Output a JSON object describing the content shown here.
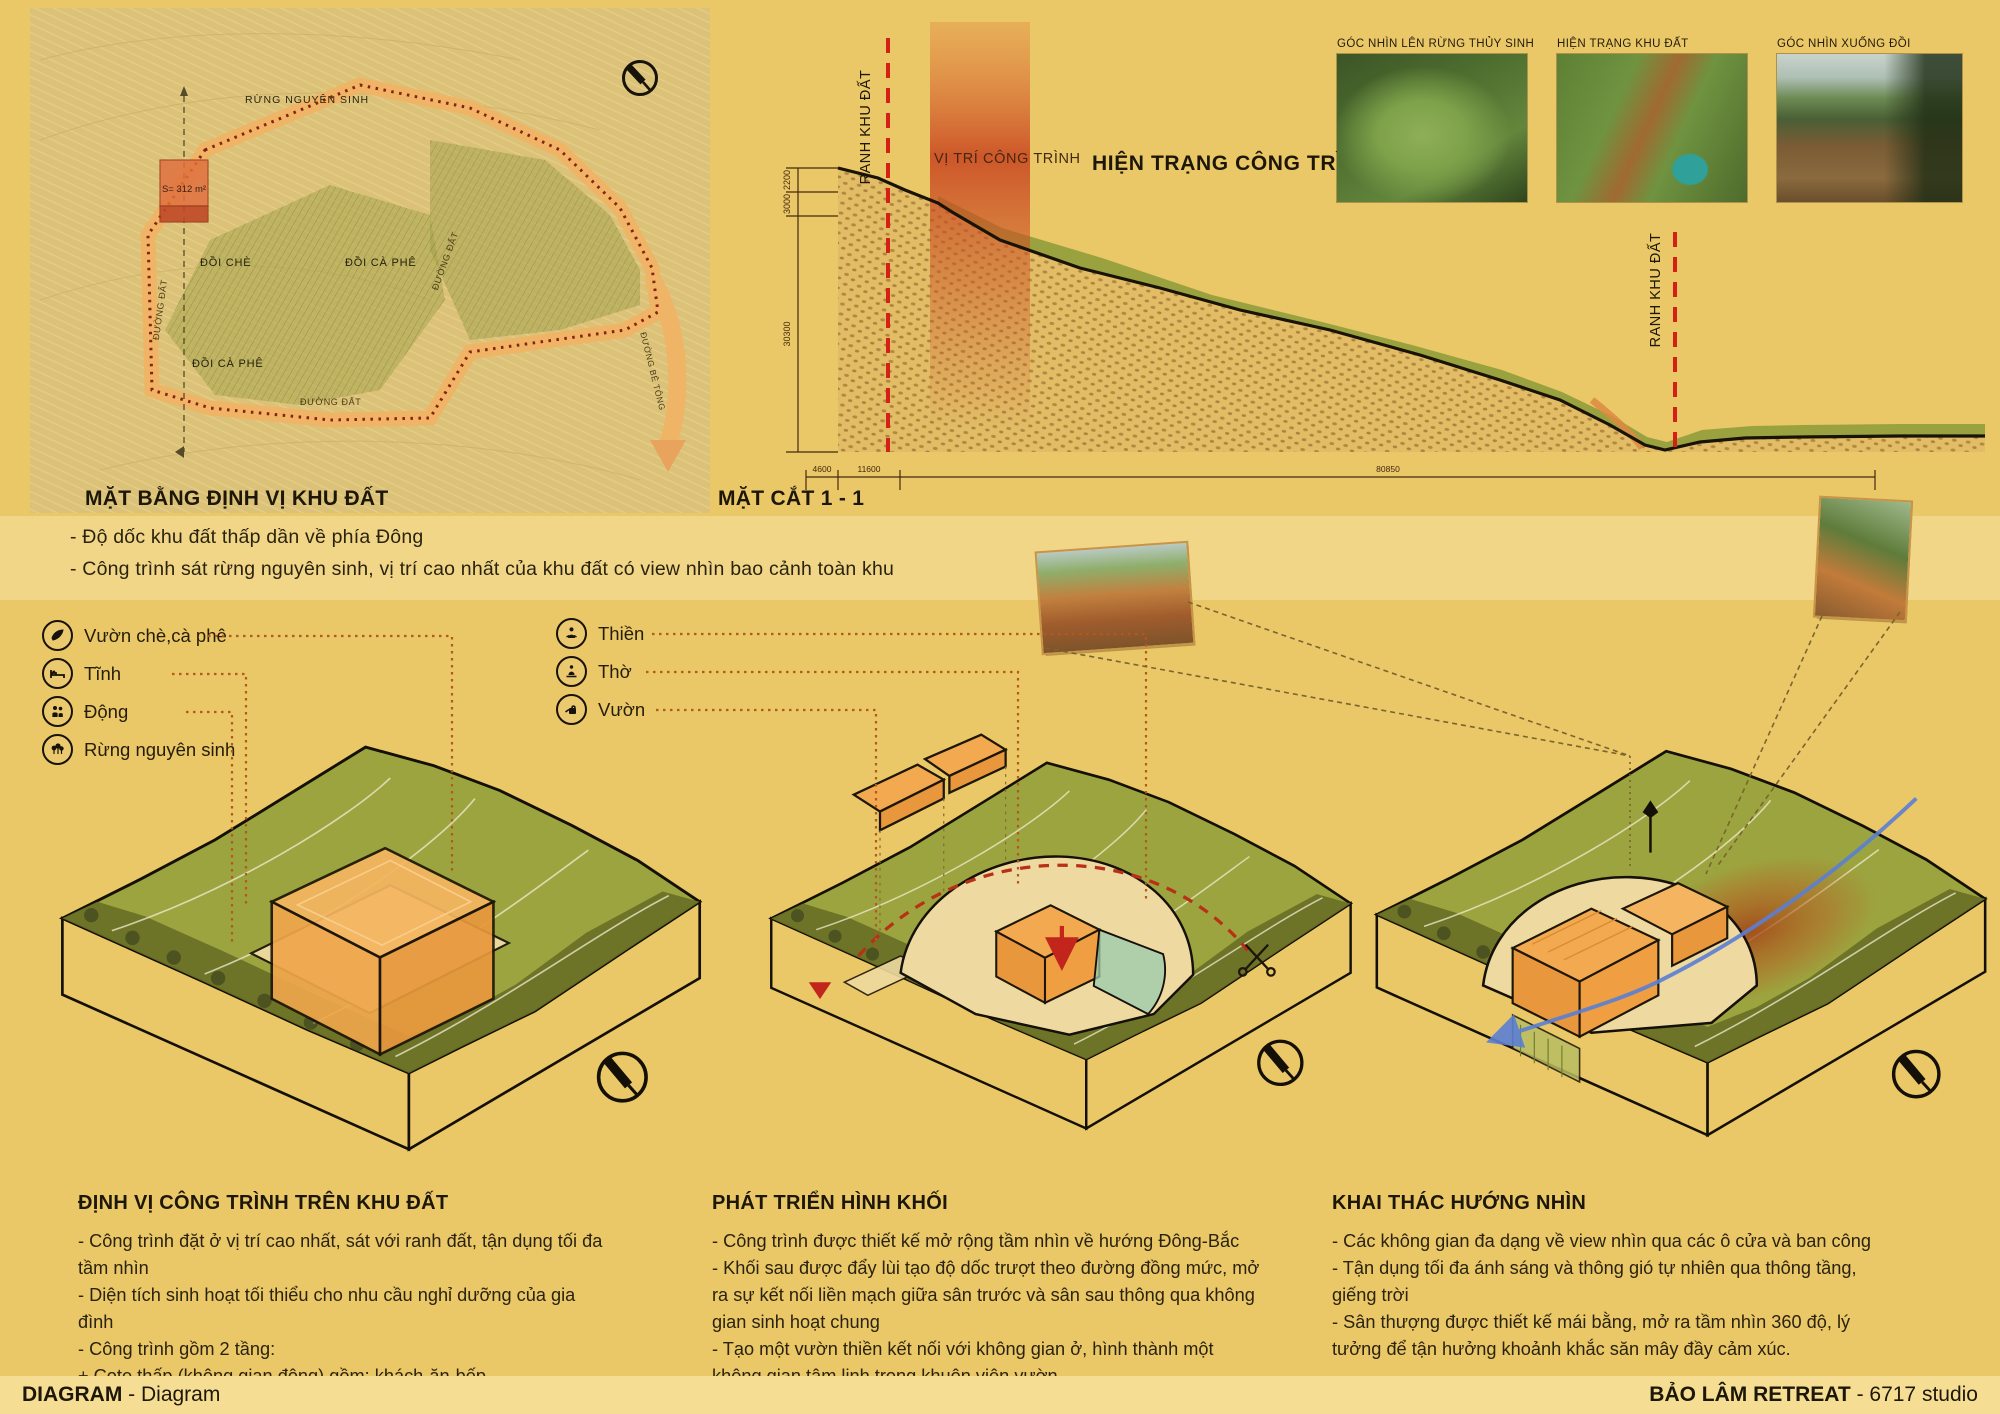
{
  "colors": {
    "board_bg": "#eac767",
    "panel_light": "#f1d687",
    "terrain_green": "#9ca43f",
    "dark_olive_band": "#6b7226",
    "building_orange": "#f0a84e",
    "platform_cream": "#eedaa0",
    "accent_red": "#d42015",
    "leader_orange": "#b3591d",
    "road_orange": "#efb466",
    "boundary_red": "#8b2012",
    "ink": "#1d1708",
    "wind_blue": "#5b7fd4"
  },
  "plan": {
    "title": "MẶT BẰNG ĐỊNH VỊ KHU ĐẤT",
    "area_label": "S= 312 m²",
    "labels": {
      "forest": "RỪNG NGUYÊN SINH",
      "tea_hill": "ĐỒI CHÈ",
      "coffee_hill": "ĐỒI CÀ PHÊ",
      "coffee_hill_2": "ĐỒI CÀ PHÊ",
      "dirt_road_left": "ĐƯỜNG ĐẤT",
      "dirt_road_bottom": "ĐƯỜNG ĐẤT",
      "dirt_road_right": "ĐƯỜNG ĐẤT",
      "concrete_road": "ĐƯỜNG BÊ TÔNG"
    },
    "notes": [
      "- Độ dốc khu đất thấp dần về phía Đông",
      "- Công trình sát rừng nguyên sinh, vị trí cao nhất của khu đất có view nhìn bao cảnh toàn khu"
    ]
  },
  "cross_section": {
    "title": "MẶT CẮT 1 - 1",
    "heading": "HIỆN TRẠNG CÔNG TRÌNH",
    "position_label": "VỊ TRÍ CÔNG TRÌNH",
    "boundary_left": "RANH KHU ĐẤT",
    "boundary_right": "RANH KHU ĐẤT",
    "dims_vertical": [
      "2200",
      "3000",
      "30300"
    ],
    "dims_horizontal": [
      "4600",
      "11600",
      "80850"
    ]
  },
  "photos": [
    {
      "caption": "GÓC NHÌN LÊN RỪNG THỦY SINH"
    },
    {
      "caption": "HIỆN TRẠNG KHU ĐẤT"
    },
    {
      "caption": "GÓC NHÌN XUỐNG ĐỒI"
    }
  ],
  "legend_site": [
    {
      "icon": "leaf-icon",
      "label": "Vườn chè,cà phê"
    },
    {
      "icon": "bed-icon",
      "label": "Tĩnh"
    },
    {
      "icon": "people-icon",
      "label": "Động"
    },
    {
      "icon": "forest-icon",
      "label": "Rừng nguyên sinh"
    }
  ],
  "legend_program": [
    {
      "icon": "meditation-icon",
      "label": "Thiền"
    },
    {
      "icon": "worship-icon",
      "label": "Thờ"
    },
    {
      "icon": "garden-icon",
      "label": "Vườn"
    }
  ],
  "columns": [
    {
      "heading": "ĐỊNH VỊ CÔNG TRÌNH TRÊN KHU ĐẤT",
      "lines": [
        "- Công trình đặt ở vị trí cao nhất, sát với ranh đất, tận dụng tối đa tầm nhìn",
        "- Diện tích sinh hoạt tối thiểu cho nhu cầu nghỉ dưỡng của gia đình",
        "- Công trình gồm 2 tầng:",
        "+ Cote thấp (không gian động) gồm: khách-ăn-bếp",
        "+ Cote cao (không gian tĩnh) gồm:  các phòng ngủ"
      ]
    },
    {
      "heading": "PHÁT TRIỂN HÌNH KHỐI",
      "lines": [
        "- Công trình được thiết kế mở rộng tầm nhìn về hướng Đông-Bắc",
        " - Khối sau được đẩy lùi tạo độ dốc trượt theo đường đồng mức, mở ra sự kết nối liền mạch giữa sân trước và sân sau thông qua không gian sinh hoạt chung",
        "- Tạo một vườn thiền kết nối với không gian ở, hình thành một không gian tâm linh trong khuôn viên vườn"
      ]
    },
    {
      "heading": "KHAI THÁC HƯỚNG NHÌN",
      "lines": [
        "- Các không gian đa dạng về view nhìn qua các ô cửa và ban công",
        "- Tận dụng tối đa ánh sáng và thông gió tự nhiên qua thông tầng, giếng trời",
        "- Sân thượng được thiết kế mái bằng, mở ra tầm nhìn 360 độ, lý tưởng để tận hưởng khoảnh khắc săn mây đầy cảm xúc."
      ]
    }
  ],
  "footer": {
    "left_bold": "DIAGRAM",
    "left_rest": " - Diagram",
    "right_bold": "BẢO LÂM RETREAT",
    "right_rest": " - 6717 studio"
  }
}
